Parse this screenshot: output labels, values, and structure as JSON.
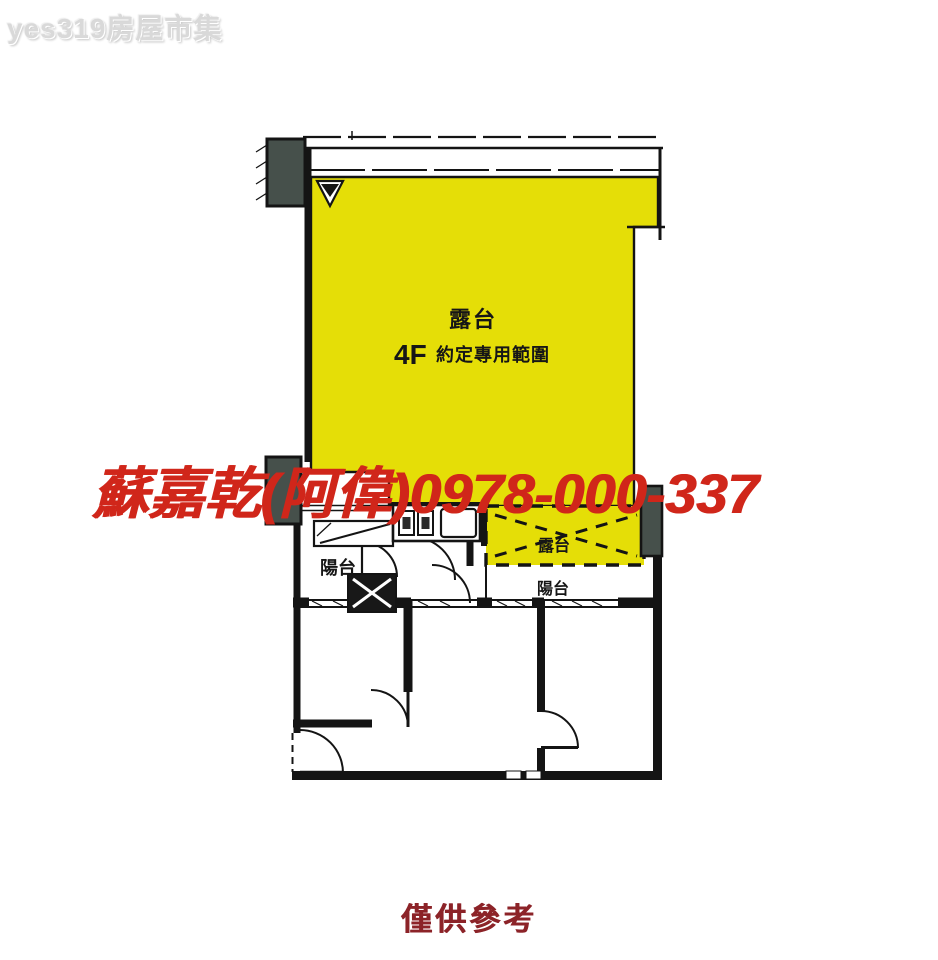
{
  "page": {
    "site_watermark": "yes319房屋市集",
    "agent_watermark": "蘇嘉乾(阿偉)0978-000-337",
    "disclaimer": "僅供參考"
  },
  "floorplan": {
    "labels": {
      "main_terrace": "露台",
      "floor_tag": "4F",
      "exclusive_use": "約定專用範圍",
      "small_terrace": "露台",
      "left_balcony": "陽台",
      "right_balcony": "陽台"
    },
    "colors": {
      "highlight_yellow": "#e5de07",
      "wall_black": "#141414",
      "column_gray": "#46504b",
      "agent_red": "#d0261a",
      "disclaimer_red": "#8c2328",
      "site_gray": "#d9d9d9"
    }
  }
}
